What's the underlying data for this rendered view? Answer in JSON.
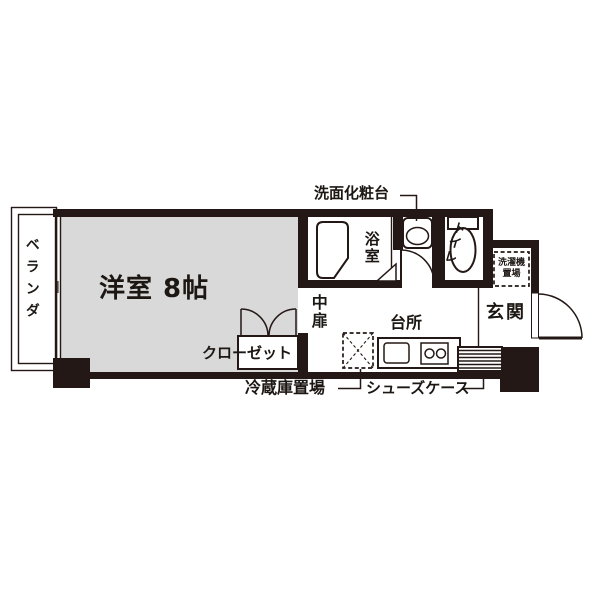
{
  "colors": {
    "wall": "#231815",
    "room_fill": "#d9d9d9",
    "line": "#231815",
    "text": "#1d1713",
    "background": "#ffffff"
  },
  "plan": {
    "balcony_label": "ベランダ",
    "main_room_label": "洋室 8帖",
    "closet_label": "クローゼット",
    "bathroom_label": "浴室",
    "toilet_label": "トイレ",
    "middle_door_label": "中扉",
    "kitchen_label": "台所",
    "entrance_label": "玄関",
    "washer_line1": "洗濯機",
    "washer_line2": "置場",
    "vanity_label": "洗面化粧台",
    "refrigerator_label": "冷蔵庫置場",
    "shoe_case_label": "シューズケース"
  }
}
